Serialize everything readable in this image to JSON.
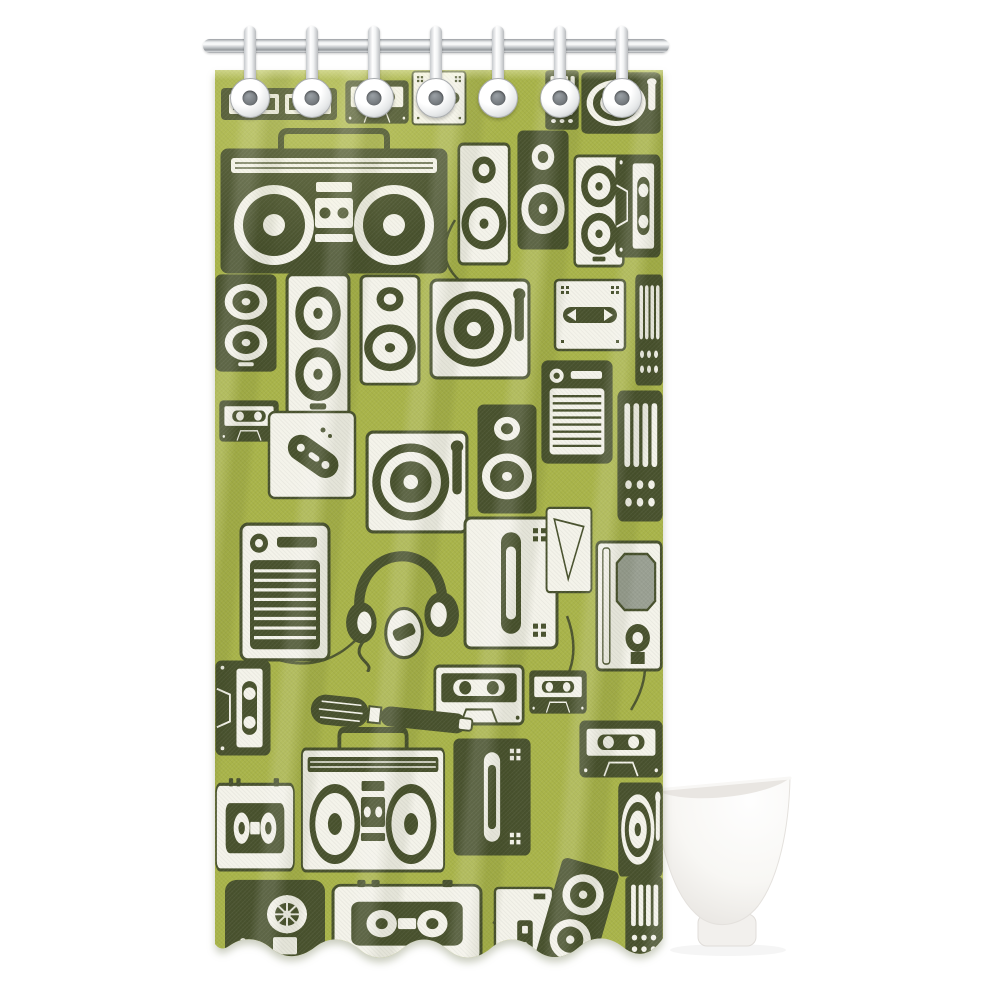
{
  "meta": {
    "product_title": "Retro music devices pattern fabric shower curtain",
    "scene_description": "Olive green fabric shower curtain printed with a dense pattern of vintage audio electronics (boomboxes, cassette tapes, turntables, speakers, reel-to-reel decks, headphones, walkmans, radios, microphones and mixers) in dark olive and cream, hanging from a chrome rod by seven white plastic rings, with a white freestanding bathtub partially visible at the lower right on a plain white background."
  },
  "colors": {
    "page_bg": "#ffffff",
    "curtain_green": "#a9b44a",
    "curtain_green_light": "#c3cc63",
    "curtain_green_deep": "#86932f",
    "device_dark": "#49522e",
    "device_cream": "#f4f3ea",
    "amp_grille_gray": "#9aa093",
    "rod_light": "#eef0f1",
    "rod_dark": "#8f9397",
    "hook_white": "#fcfcfc",
    "hook_hole": "#6d7276",
    "tub_white": "#fcfbfa",
    "tub_shade": "#e7e4e0",
    "tub_rim": "#e9e6e2"
  },
  "curtain": {
    "hook_count": 7,
    "motifs": [
      "boombox",
      "cassette-tape",
      "turntable",
      "speaker",
      "reel-to-reel-deck",
      "headphones",
      "walkman",
      "radio",
      "microphone",
      "mixer",
      "game-controller",
      "amplifier",
      "tape-deck",
      "audio-cables"
    ]
  },
  "fixtures": {
    "rod": "shower-rod",
    "tub": "freestanding-bathtub"
  }
}
